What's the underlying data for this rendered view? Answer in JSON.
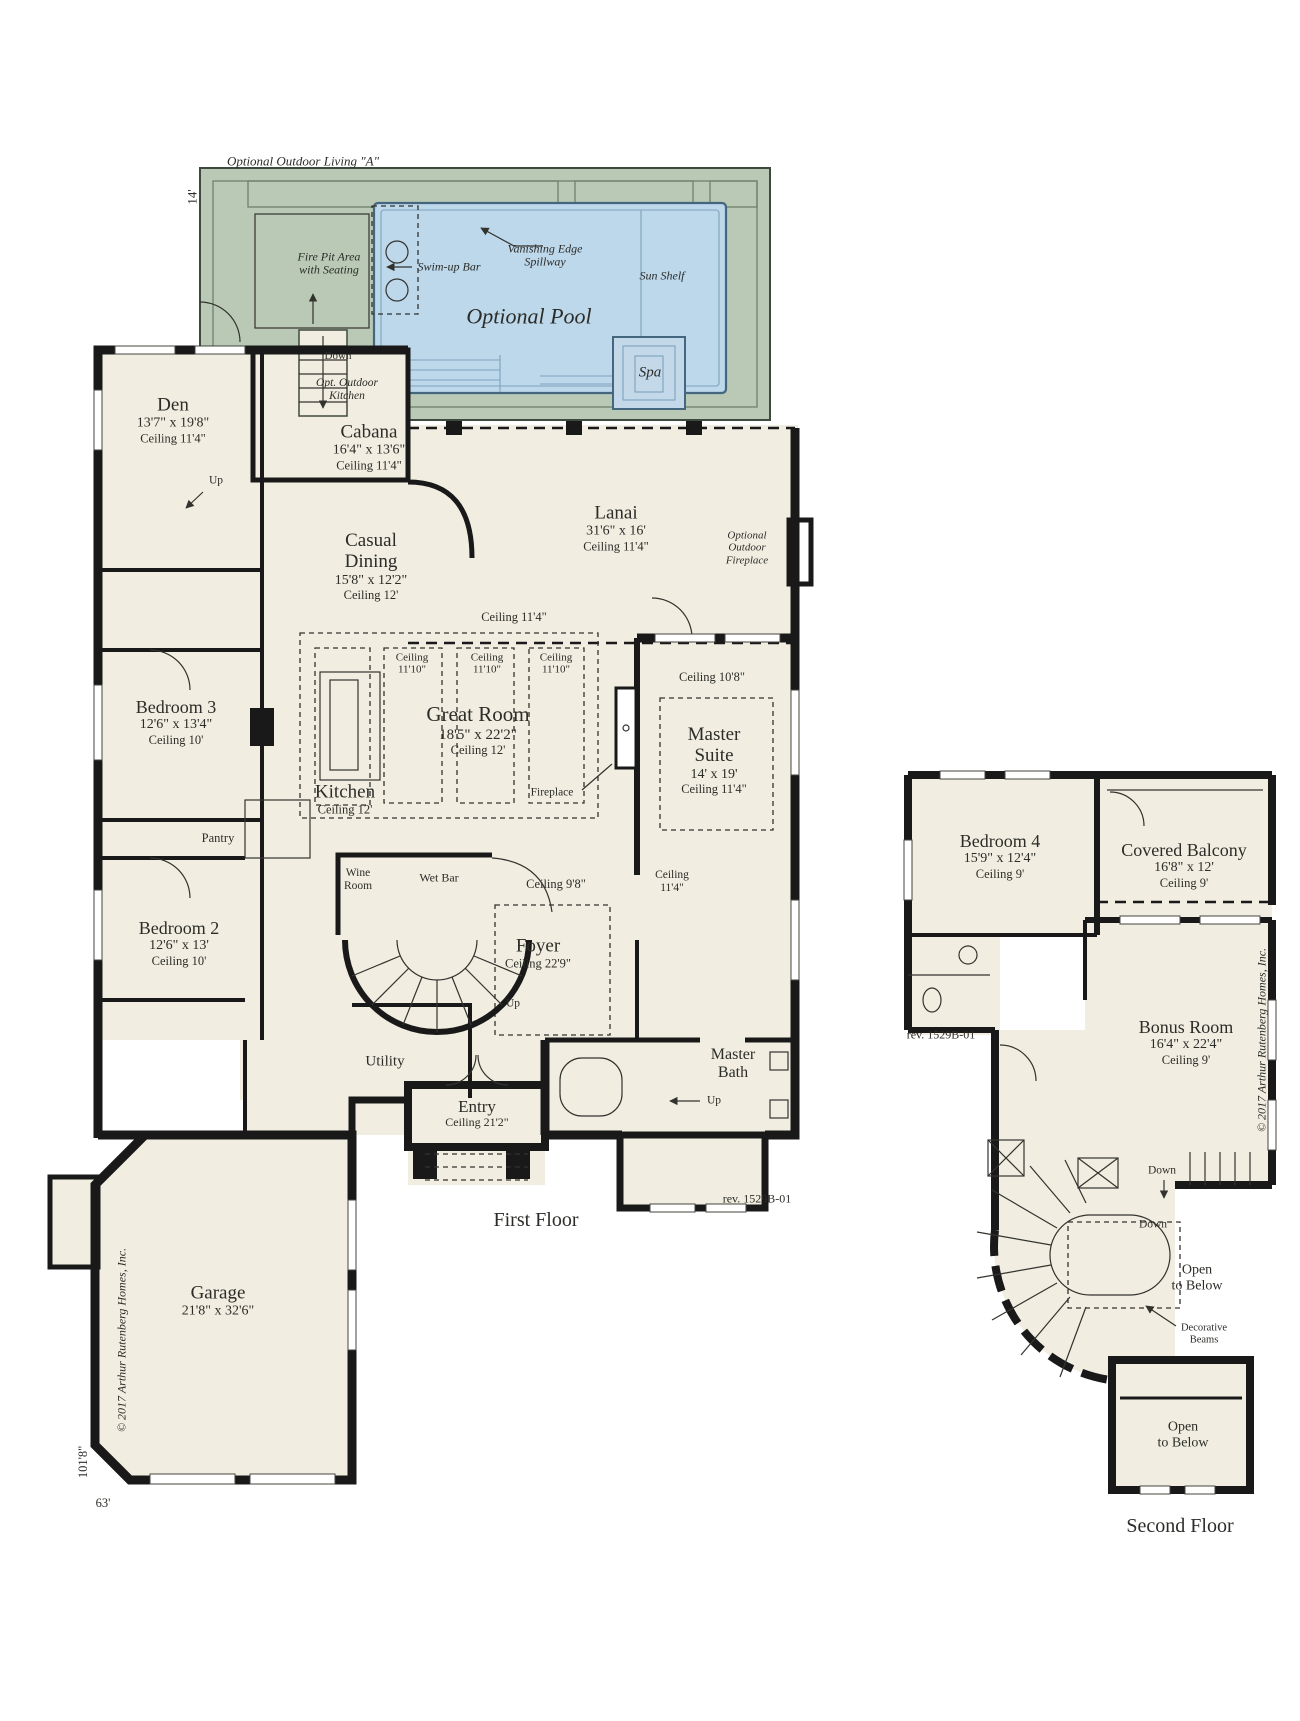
{
  "colors": {
    "background": "#ffffff",
    "floor": "#f1eee1",
    "deck": "#b9c9b6",
    "pool": "#bdd7eb",
    "pool_line": "#44677f",
    "wall": "#191919",
    "ink": "#2c2c28"
  },
  "labels": [
    {
      "name": "outdoor-living-title",
      "x": 303,
      "y": 162,
      "italic": true,
      "lines": [
        {
          "t": "Optional Outdoor Living \"A\"",
          "s": 13
        }
      ]
    },
    {
      "name": "pool-depth-dim",
      "x": 193,
      "y": 197,
      "rot": -90,
      "lines": [
        {
          "t": "14'",
          "s": 13
        }
      ]
    },
    {
      "name": "fire-pit-label",
      "x": 329,
      "y": 264,
      "italic": true,
      "lines": [
        {
          "t": "Fire Pit Area",
          "s": 12
        },
        {
          "t": "with Seating",
          "s": 12
        }
      ]
    },
    {
      "name": "swim-up-bar-label",
      "x": 449,
      "y": 267,
      "italic": true,
      "lines": [
        {
          "t": "Swim-up Bar",
          "s": 12
        }
      ]
    },
    {
      "name": "vanishing-edge-label",
      "x": 545,
      "y": 256,
      "italic": true,
      "lines": [
        {
          "t": "Vanishing Edge",
          "s": 12
        },
        {
          "t": "Spillway",
          "s": 12
        }
      ]
    },
    {
      "name": "sun-shelf-label",
      "x": 662,
      "y": 276,
      "italic": true,
      "lines": [
        {
          "t": "Sun Shelf",
          "s": 12
        }
      ]
    },
    {
      "name": "optional-pool-label",
      "x": 529,
      "y": 317,
      "italic": true,
      "lines": [
        {
          "t": "Optional Pool",
          "s": 22
        }
      ]
    },
    {
      "name": "spa-label",
      "x": 650,
      "y": 373,
      "italic": true,
      "lines": [
        {
          "t": "Spa",
          "s": 15
        }
      ]
    },
    {
      "name": "pool-down-label",
      "x": 338,
      "y": 356,
      "lines": [
        {
          "t": "Down",
          "s": 11
        }
      ]
    },
    {
      "name": "opt-outdoor-kitchen-label",
      "x": 347,
      "y": 390,
      "italic": true,
      "lines": [
        {
          "t": "Opt. Outdoor",
          "s": 11.5
        },
        {
          "t": "Kitchen",
          "s": 11.5
        }
      ]
    },
    {
      "name": "cabana-label",
      "x": 369,
      "y": 447,
      "lines": [
        {
          "t": "Cabana",
          "s": 19
        },
        {
          "t": "16'4\" x 13'6\"",
          "s": 14
        },
        {
          "t": "Ceiling 11'4\"",
          "s": 12.5
        }
      ]
    },
    {
      "name": "den-label",
      "x": 173,
      "y": 420,
      "lines": [
        {
          "t": "Den",
          "s": 19
        },
        {
          "t": "13'7\" x 19'8\"",
          "s": 14
        },
        {
          "t": "Ceiling 11'4\"",
          "s": 12.5
        }
      ]
    },
    {
      "name": "den-up-label",
      "x": 216,
      "y": 481,
      "lines": [
        {
          "t": "Up",
          "s": 11.5
        }
      ]
    },
    {
      "name": "casual-dining-label",
      "x": 371,
      "y": 566,
      "lines": [
        {
          "t": "Casual",
          "s": 19
        },
        {
          "t": "Dining",
          "s": 19
        },
        {
          "t": "15'8\" x 12'2\"",
          "s": 14
        },
        {
          "t": "Ceiling 12'",
          "s": 12.5
        }
      ]
    },
    {
      "name": "lanai-label",
      "x": 616,
      "y": 528,
      "lines": [
        {
          "t": "Lanai",
          "s": 19
        },
        {
          "t": "31'6\" x 16'",
          "s": 14
        },
        {
          "t": "Ceiling 11'4\"",
          "s": 12.5
        }
      ]
    },
    {
      "name": "outdoor-fireplace-label",
      "x": 747,
      "y": 548,
      "italic": true,
      "lines": [
        {
          "t": "Optional",
          "s": 11
        },
        {
          "t": "Outdoor",
          "s": 11
        },
        {
          "t": "Fireplace",
          "s": 11
        }
      ]
    },
    {
      "name": "greatroom-ceiling-label",
      "x": 514,
      "y": 617,
      "lines": [
        {
          "t": "Ceiling 11'4\"",
          "s": 12.5
        }
      ]
    },
    {
      "name": "tray1-ceiling-label",
      "x": 412,
      "y": 664,
      "lines": [
        {
          "t": "Ceiling",
          "s": 11
        },
        {
          "t": "11'10\"",
          "s": 11
        }
      ]
    },
    {
      "name": "tray2-ceiling-label",
      "x": 487,
      "y": 664,
      "lines": [
        {
          "t": "Ceiling",
          "s": 11
        },
        {
          "t": "11'10\"",
          "s": 11
        }
      ]
    },
    {
      "name": "tray3-ceiling-label",
      "x": 556,
      "y": 664,
      "lines": [
        {
          "t": "Ceiling",
          "s": 11
        },
        {
          "t": "11'10\"",
          "s": 11
        }
      ]
    },
    {
      "name": "great-room-label",
      "x": 478,
      "y": 730,
      "lines": [
        {
          "t": "Great Room",
          "s": 21
        },
        {
          "t": "18'5\" x 22'2\"",
          "s": 15
        },
        {
          "t": "Ceiling 12'",
          "s": 12.5
        }
      ]
    },
    {
      "name": "fireplace-label",
      "x": 552,
      "y": 793,
      "lines": [
        {
          "t": "Fireplace",
          "s": 11.5
        }
      ]
    },
    {
      "name": "kitchen-label",
      "x": 345,
      "y": 799,
      "lines": [
        {
          "t": "Kitchen",
          "s": 19
        },
        {
          "t": "Ceiling 12'",
          "s": 12.5
        }
      ]
    },
    {
      "name": "master-ceiling-label",
      "x": 712,
      "y": 677,
      "lines": [
        {
          "t": "Ceiling 10'8\"",
          "s": 12.5
        }
      ]
    },
    {
      "name": "master-suite-label",
      "x": 714,
      "y": 760,
      "lines": [
        {
          "t": "Master",
          "s": 19
        },
        {
          "t": "Suite",
          "s": 19
        },
        {
          "t": "14' x 19'",
          "s": 14
        },
        {
          "t": "Ceiling 11'4\"",
          "s": 12.5
        }
      ]
    },
    {
      "name": "bedroom3-label",
      "x": 176,
      "y": 722,
      "lines": [
        {
          "t": "Bedroom 3",
          "s": 18
        },
        {
          "t": "12'6\" x 13'4\"",
          "s": 14
        },
        {
          "t": "Ceiling 10'",
          "s": 12.5
        }
      ]
    },
    {
      "name": "pantry-label",
      "x": 218,
      "y": 838,
      "lines": [
        {
          "t": "Pantry",
          "s": 12.5
        }
      ]
    },
    {
      "name": "bedroom2-label",
      "x": 179,
      "y": 943,
      "lines": [
        {
          "t": "Bedroom 2",
          "s": 18
        },
        {
          "t": "12'6\" x 13'",
          "s": 14
        },
        {
          "t": "Ceiling 10'",
          "s": 12.5
        }
      ]
    },
    {
      "name": "wine-room-label",
      "x": 358,
      "y": 880,
      "lines": [
        {
          "t": "Wine",
          "s": 11.5
        },
        {
          "t": "Room",
          "s": 11.5
        }
      ]
    },
    {
      "name": "wet-bar-label",
      "x": 439,
      "y": 878,
      "lines": [
        {
          "t": "Wet Bar",
          "s": 12
        }
      ]
    },
    {
      "name": "foyer-ceiling-label",
      "x": 556,
      "y": 884,
      "lines": [
        {
          "t": "Ceiling 9'8\"",
          "s": 12.5
        }
      ]
    },
    {
      "name": "hall-ceiling-label",
      "x": 672,
      "y": 882,
      "lines": [
        {
          "t": "Ceiling",
          "s": 11.5
        },
        {
          "t": "11'4\"",
          "s": 11.5
        }
      ]
    },
    {
      "name": "foyer-label",
      "x": 538,
      "y": 953,
      "lines": [
        {
          "t": "Foyer",
          "s": 19
        },
        {
          "t": "Ceiling 22'9\"",
          "s": 12.5
        }
      ]
    },
    {
      "name": "foyer-up-label",
      "x": 513,
      "y": 1004,
      "lines": [
        {
          "t": "Up",
          "s": 11.5
        }
      ]
    },
    {
      "name": "utility-label",
      "x": 385,
      "y": 1062,
      "lines": [
        {
          "t": "Utility",
          "s": 15
        }
      ]
    },
    {
      "name": "entry-label",
      "x": 477,
      "y": 1113,
      "lines": [
        {
          "t": "Entry",
          "s": 17
        },
        {
          "t": "Ceiling 21'2\"",
          "s": 12
        }
      ]
    },
    {
      "name": "master-bath-label",
      "x": 733,
      "y": 1064,
      "lines": [
        {
          "t": "Master",
          "s": 16
        },
        {
          "t": "Bath",
          "s": 16
        }
      ]
    },
    {
      "name": "master-bath-up-label",
      "x": 714,
      "y": 1101,
      "lines": [
        {
          "t": "Up",
          "s": 11.5
        }
      ]
    },
    {
      "name": "first-floor-rev-label",
      "x": 757,
      "y": 1199,
      "lines": [
        {
          "t": "rev. 1529B-01",
          "s": 12
        }
      ]
    },
    {
      "name": "first-floor-title",
      "x": 536,
      "y": 1220,
      "lines": [
        {
          "t": "First Floor",
          "s": 20
        }
      ]
    },
    {
      "name": "garage-label",
      "x": 218,
      "y": 1301,
      "lines": [
        {
          "t": "Garage",
          "s": 19
        },
        {
          "t": "21'8\" x 32'6\"",
          "s": 14
        }
      ]
    },
    {
      "name": "first-floor-copyright",
      "x": 122,
      "y": 1340,
      "rot": -90,
      "italic": true,
      "lines": [
        {
          "t": "© 2017 Arthur Rutenberg Homes, Inc.",
          "s": 12
        }
      ]
    },
    {
      "name": "height-dim-label",
      "x": 83,
      "y": 1462,
      "rot": -90,
      "lines": [
        {
          "t": "101'8\"",
          "s": 12.5
        }
      ]
    },
    {
      "name": "width-dim-label",
      "x": 103,
      "y": 1503,
      "lines": [
        {
          "t": "63'",
          "s": 12.5
        }
      ]
    },
    {
      "name": "bedroom4-label",
      "x": 1000,
      "y": 856,
      "lines": [
        {
          "t": "Bedroom 4",
          "s": 18
        },
        {
          "t": "15'9\" x 12'4\"",
          "s": 14
        },
        {
          "t": "Ceiling 9'",
          "s": 12.5
        }
      ]
    },
    {
      "name": "covered-balcony-label",
      "x": 1184,
      "y": 865,
      "lines": [
        {
          "t": "Covered Balcony",
          "s": 18
        },
        {
          "t": "16'8\" x 12'",
          "s": 14
        },
        {
          "t": "Ceiling 9'",
          "s": 12.5
        }
      ]
    },
    {
      "name": "second-floor-rev-label",
      "x": 941,
      "y": 1035,
      "lines": [
        {
          "t": "rev. 1529B-01",
          "s": 12
        }
      ]
    },
    {
      "name": "bonus-room-label",
      "x": 1186,
      "y": 1042,
      "lines": [
        {
          "t": "Bonus Room",
          "s": 18
        },
        {
          "t": "16'4\" x 22'4\"",
          "s": 14
        },
        {
          "t": "Ceiling 9'",
          "s": 12.5
        }
      ]
    },
    {
      "name": "second-floor-copyright",
      "x": 1262,
      "y": 1040,
      "rot": -90,
      "italic": true,
      "lines": [
        {
          "t": "© 2017 Arthur Rutenberg Homes, Inc.",
          "s": 12
        }
      ]
    },
    {
      "name": "hall-down-label",
      "x": 1162,
      "y": 1171,
      "lines": [
        {
          "t": "Down",
          "s": 11.5
        }
      ]
    },
    {
      "name": "stair-down-label",
      "x": 1153,
      "y": 1225,
      "lines": [
        {
          "t": "Down",
          "s": 11.5
        }
      ]
    },
    {
      "name": "open-below-stair-label",
      "x": 1197,
      "y": 1278,
      "lines": [
        {
          "t": "Open",
          "s": 14
        },
        {
          "t": "to Below",
          "s": 14
        }
      ]
    },
    {
      "name": "decorative-beams-label",
      "x": 1204,
      "y": 1334,
      "lines": [
        {
          "t": "Decorative",
          "s": 10.5
        },
        {
          "t": "Beams",
          "s": 10.5
        }
      ]
    },
    {
      "name": "open-below-balcony-label",
      "x": 1183,
      "y": 1435,
      "lines": [
        {
          "t": "Open",
          "s": 14
        },
        {
          "t": "to Below",
          "s": 14
        }
      ]
    },
    {
      "name": "second-floor-title",
      "x": 1180,
      "y": 1526,
      "lines": [
        {
          "t": "Second Floor",
          "s": 20
        }
      ]
    }
  ]
}
